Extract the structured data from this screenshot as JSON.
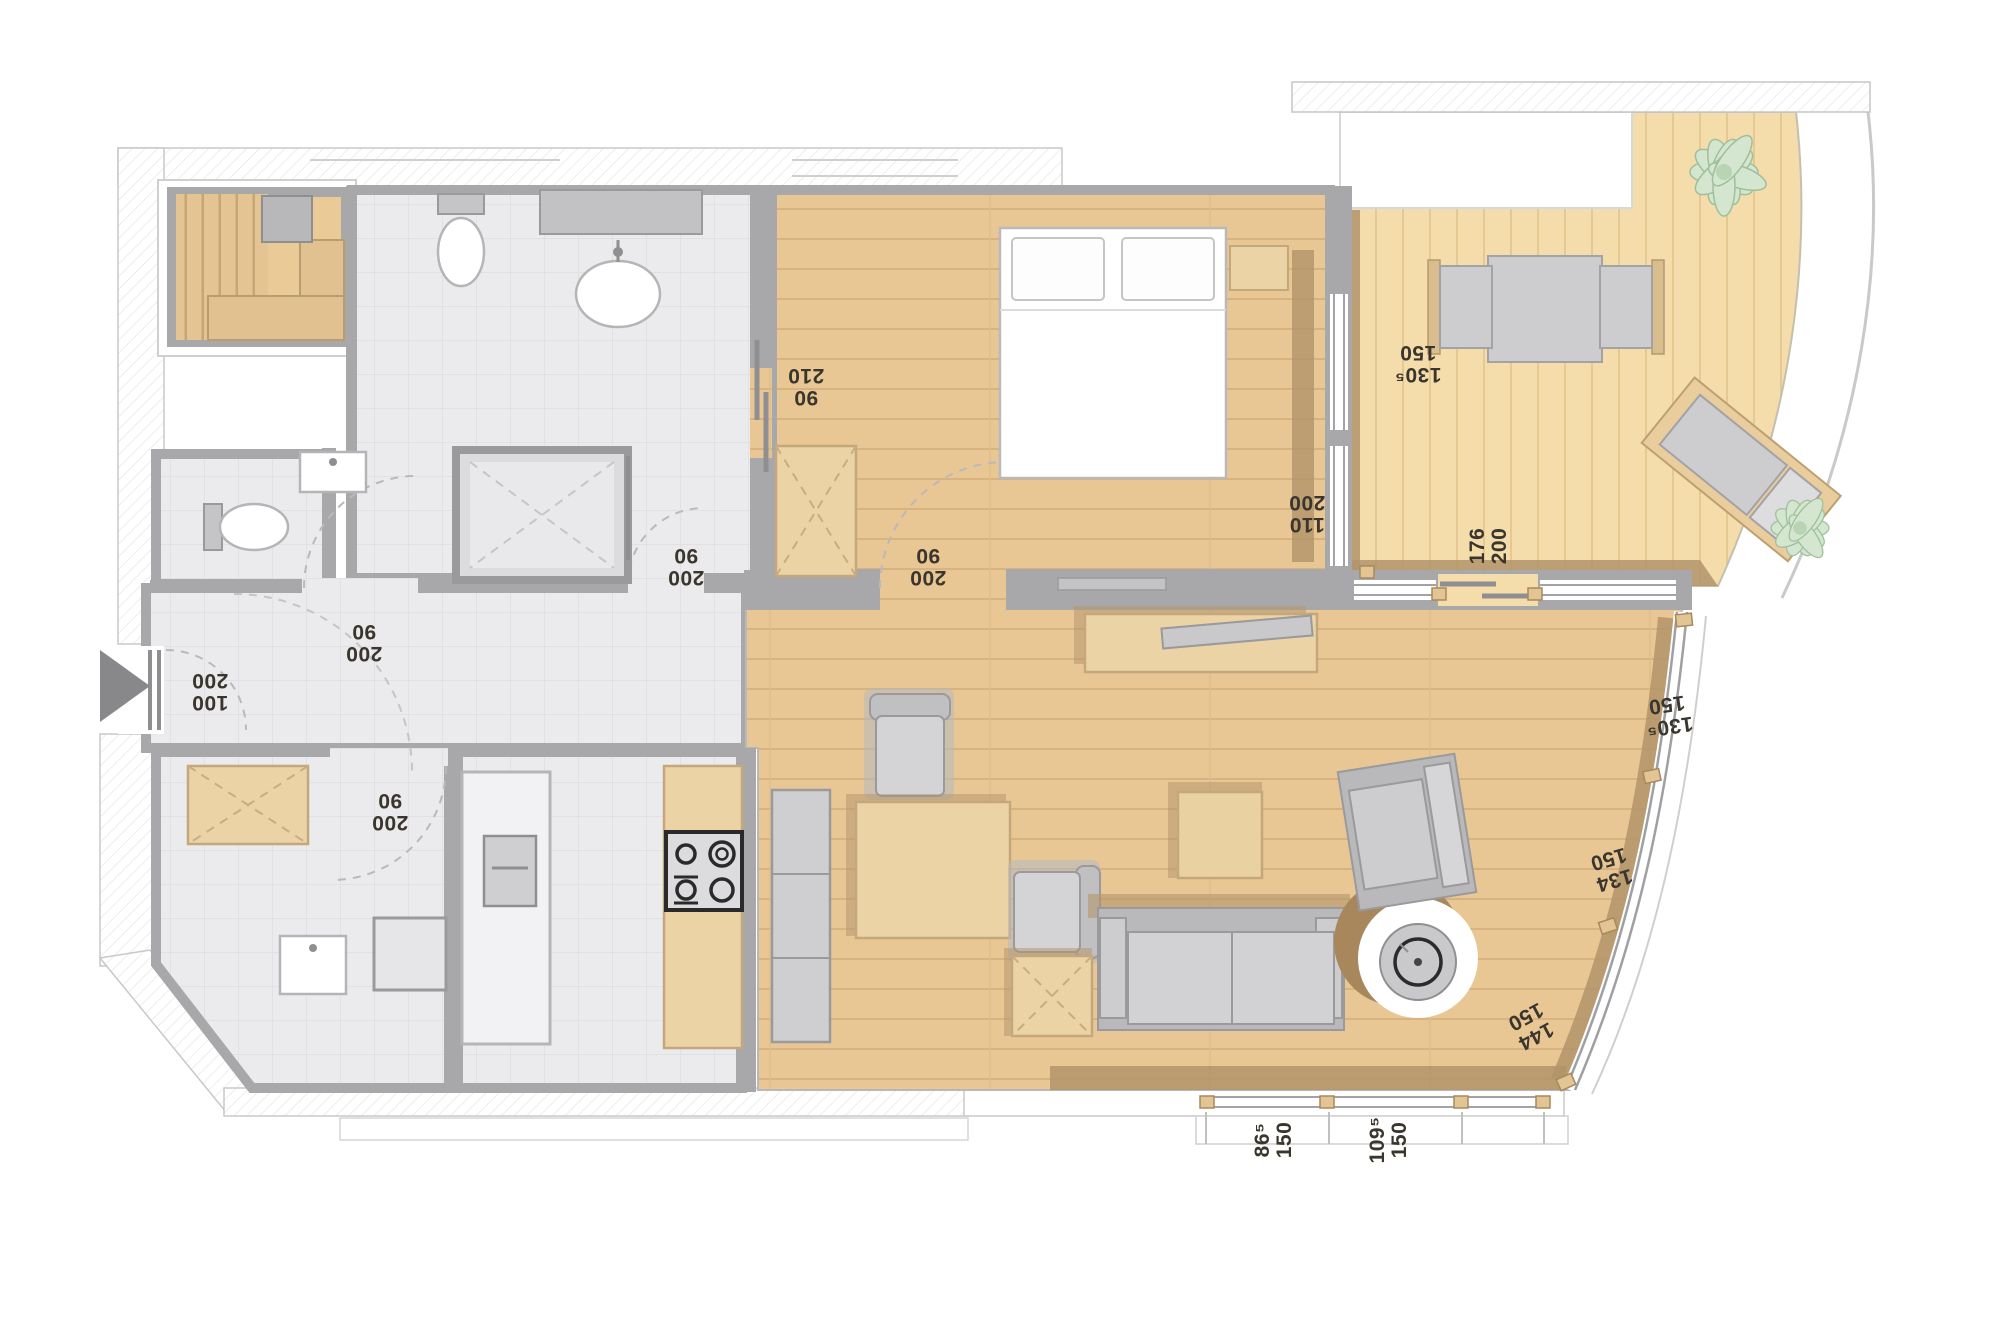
{
  "plan": {
    "type": "apartment-floor-plan",
    "colors": {
      "wood_floor": "#e9c795",
      "terrace_deck": "#f4dcab",
      "tile_floor": "#ebebed",
      "wall_grey": "#a8a8ab",
      "furniture_tan": "#ecd3a6",
      "furniture_grey": "#cdcdd0",
      "shadow_brown": "#b2946a",
      "plant_green": "#d4e6d0",
      "label_text": "#3a362e"
    },
    "labels": [
      {
        "id": "bedroom-corridor-door",
        "line1": "210",
        "line2": "90"
      },
      {
        "id": "terrace-upper-window",
        "line1": "150",
        "line2": "130⁵"
      },
      {
        "id": "bedroom-east-window",
        "line1": "200",
        "line2": "110"
      },
      {
        "id": "terrace-door",
        "line1": "176",
        "line2": "200"
      },
      {
        "id": "bathroom-door",
        "line1": "90",
        "line2": "200"
      },
      {
        "id": "bedroom-door",
        "line1": "90",
        "line2": "200"
      },
      {
        "id": "wc-door",
        "line1": "90",
        "line2": "200"
      },
      {
        "id": "entrance-door",
        "line1": "200",
        "line2": "100"
      },
      {
        "id": "utility-door",
        "line1": "90",
        "line2": "200"
      },
      {
        "id": "living-window-1",
        "line1": "150",
        "line2": "130⁵"
      },
      {
        "id": "living-window-2",
        "line1": "150",
        "line2": "134"
      },
      {
        "id": "living-window-3",
        "line1": "150",
        "line2": "144"
      },
      {
        "id": "south-window-1",
        "line1": "86⁵",
        "line2": "150"
      },
      {
        "id": "south-window-2",
        "line1": "109⁵",
        "line2": "150"
      }
    ]
  }
}
